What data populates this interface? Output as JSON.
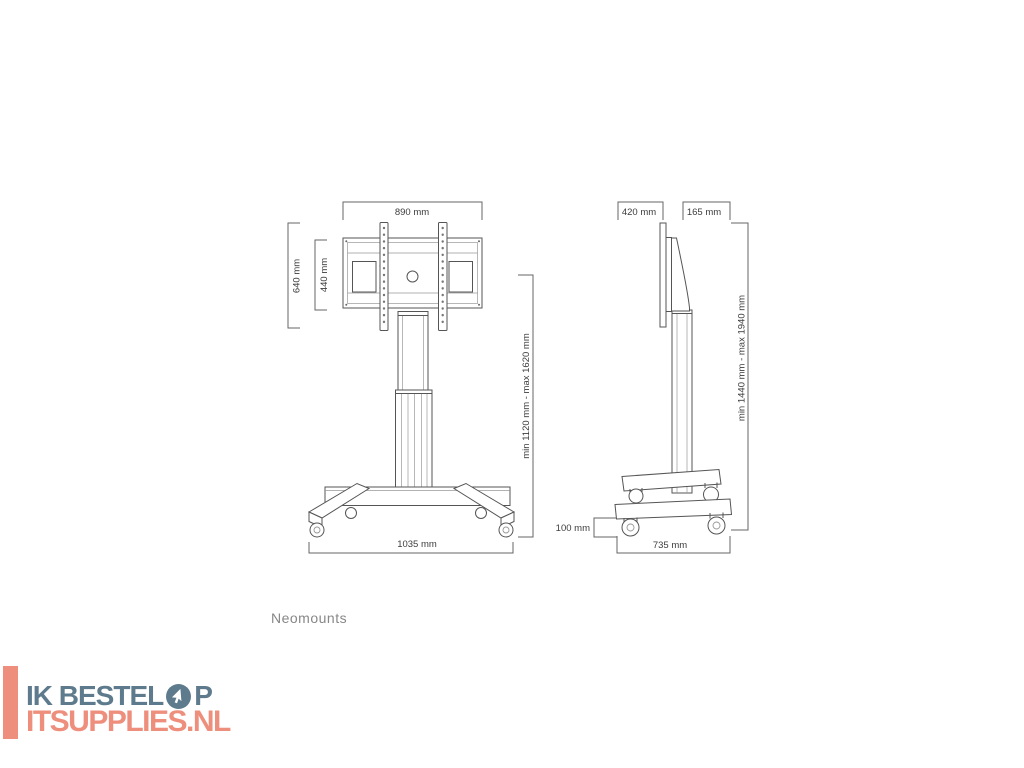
{
  "diagram": {
    "brand": "Neomounts",
    "front": {
      "width_top": "890 mm",
      "height_outer": "640 mm",
      "height_inner": "440 mm",
      "height_range": "min 1120 mm - max 1620 mm",
      "base_width": "1035 mm"
    },
    "side": {
      "depth_plate": "420 mm",
      "depth_profile": "165 mm",
      "height_range": "min 1440 mm - max 1940 mm",
      "caster_height": "100 mm",
      "base_depth": "735 mm"
    }
  },
  "watermark": {
    "line1_prefix": "IK BESTEL",
    "line1_suffix": "P",
    "line2": "ITSUPPLIES.NL",
    "icon": "cursor-in-circle-icon",
    "colors": {
      "slate": "#5d7b8c",
      "salmon": "#ee8f7e"
    }
  }
}
